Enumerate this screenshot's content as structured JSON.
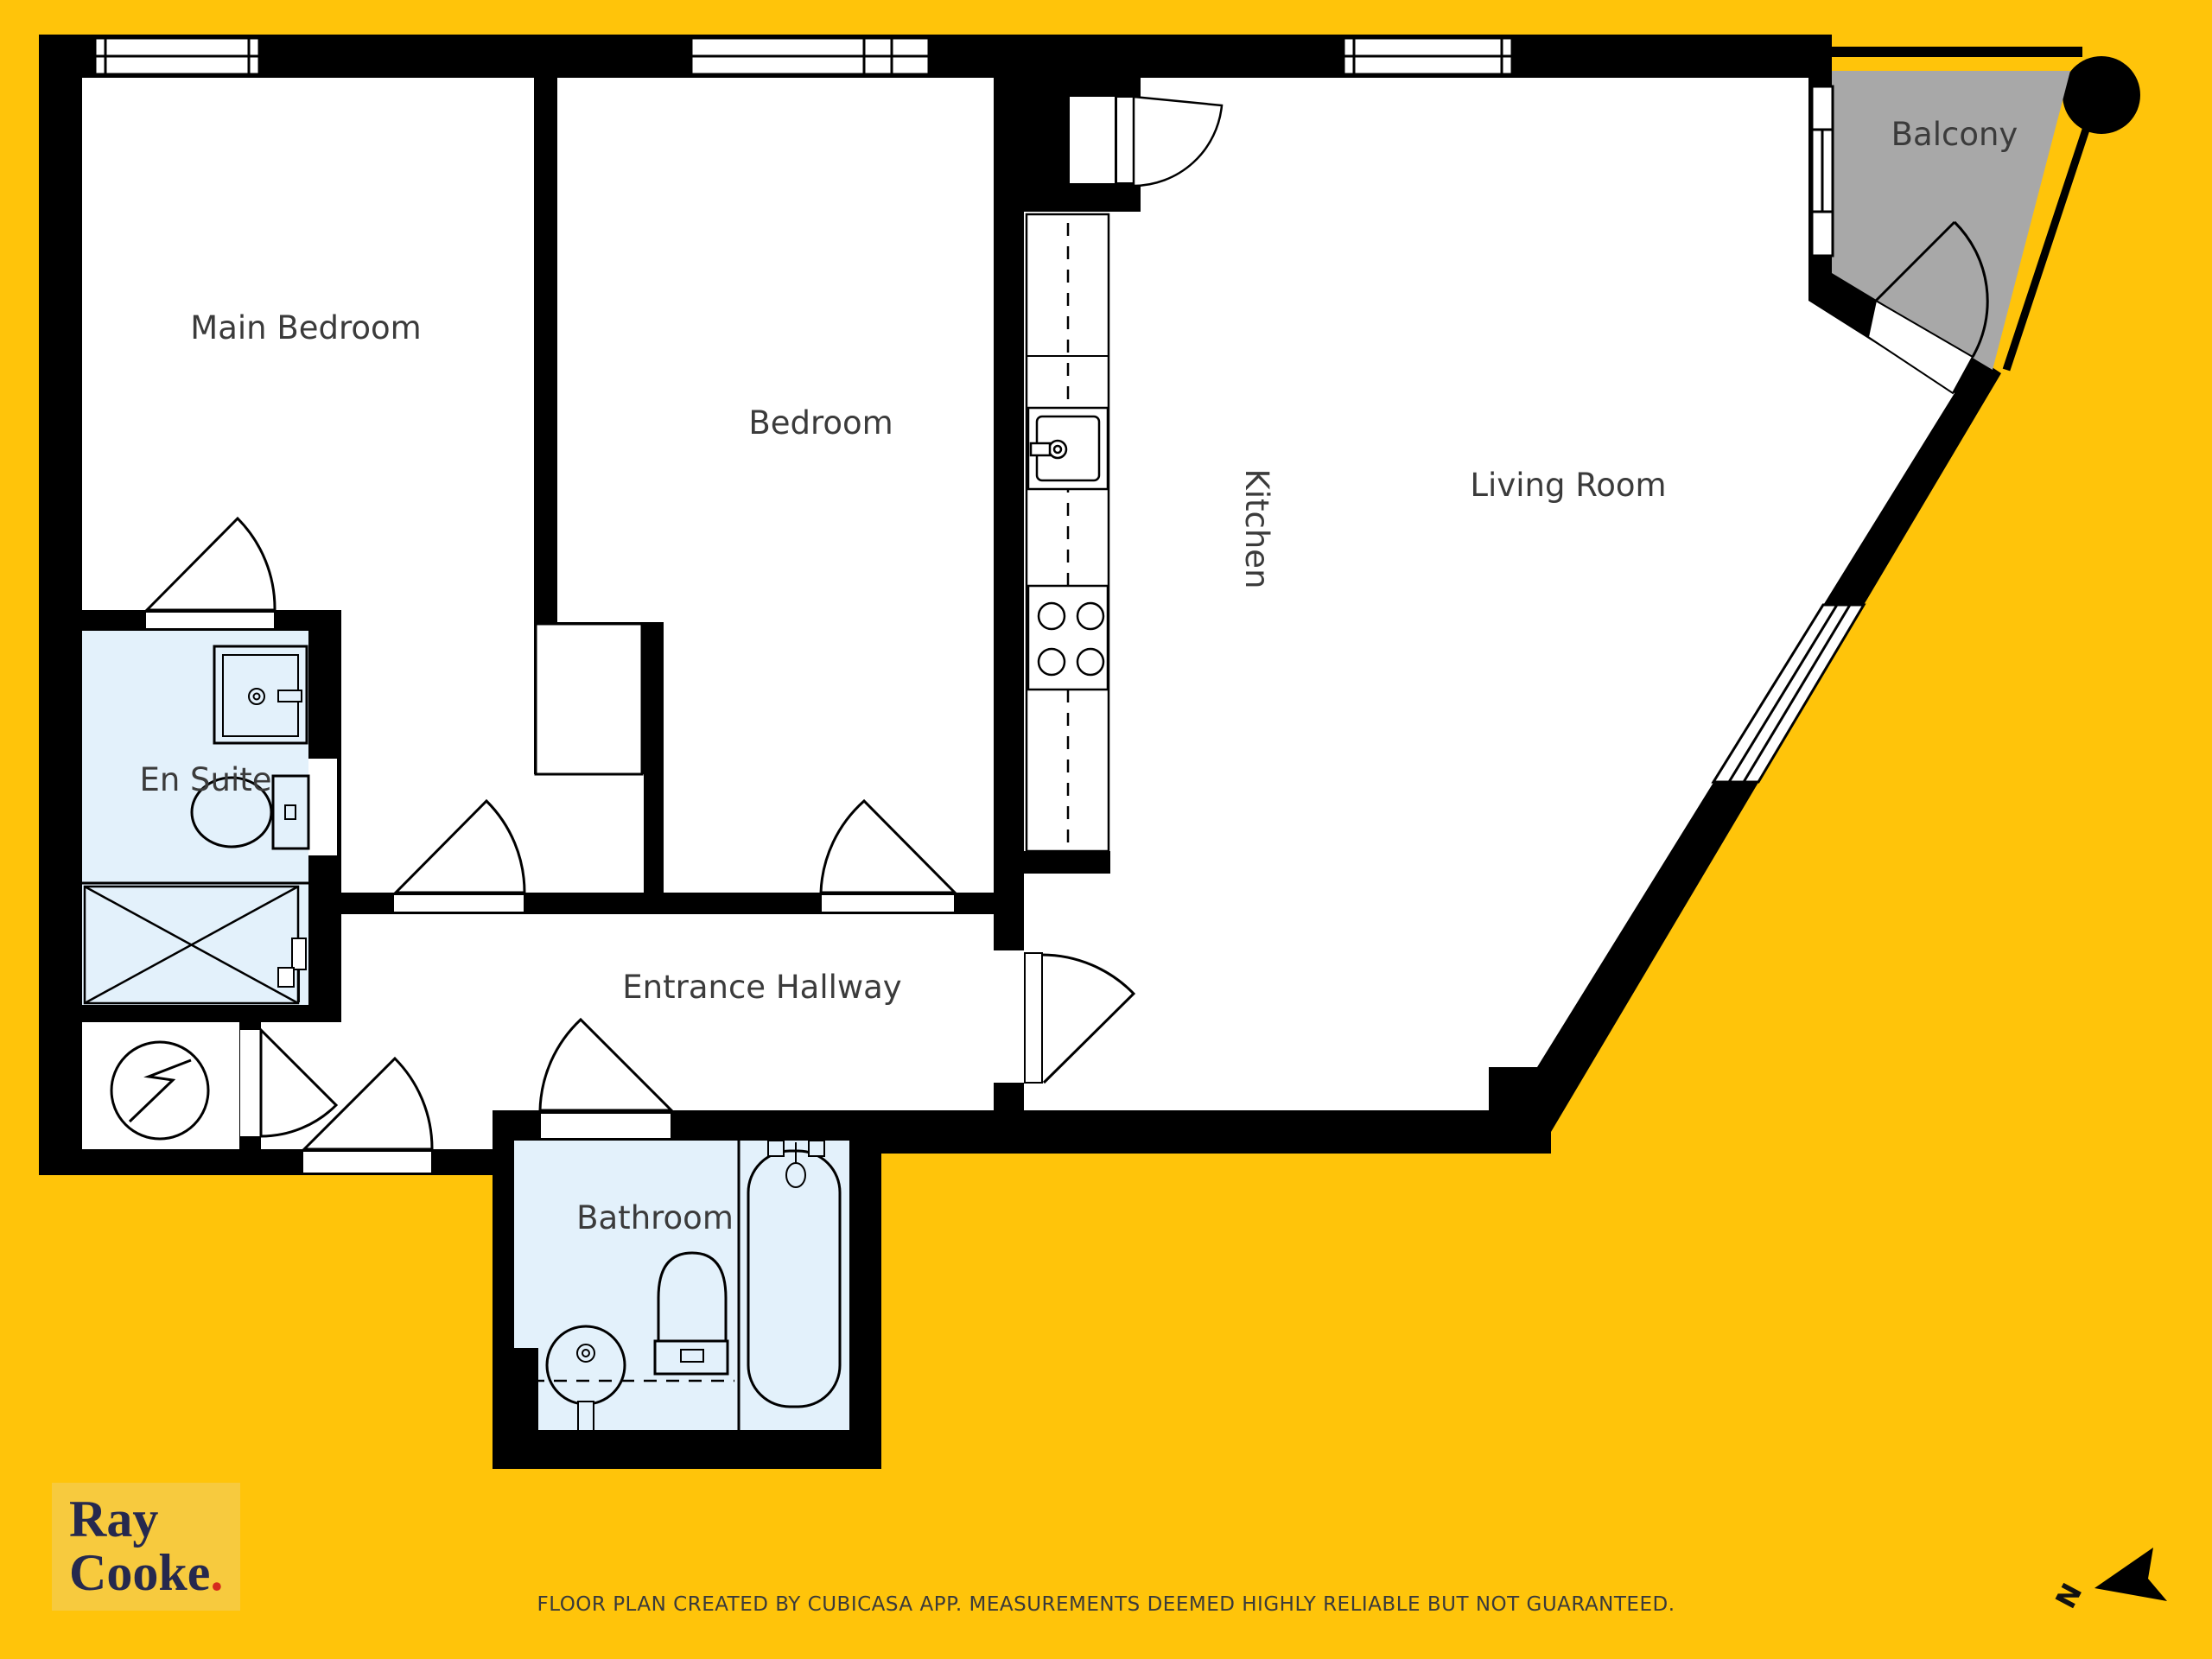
{
  "colors": {
    "background": "#FFC40A",
    "wall": "#000000",
    "wet_room_fill": "#E3F1FB",
    "balcony_fill": "#A8A8A8",
    "room_label": "#3B3B3B",
    "logo_navy": "#26294E",
    "logo_red": "#D52B1E",
    "logo_patch": "#F7CA3E"
  },
  "rooms": [
    {
      "id": "main-bedroom",
      "label": "Main Bedroom"
    },
    {
      "id": "bedroom",
      "label": "Bedroom"
    },
    {
      "id": "kitchen",
      "label": "Kitchen"
    },
    {
      "id": "living-room",
      "label": "Living Room"
    },
    {
      "id": "balcony",
      "label": "Balcony"
    },
    {
      "id": "en-suite",
      "label": "En Suite"
    },
    {
      "id": "entrance-hallway",
      "label": "Entrance Hallway"
    },
    {
      "id": "bathroom",
      "label": "Bathroom"
    }
  ],
  "branding": {
    "line1": "Ray",
    "line2": "Cooke",
    "period": "."
  },
  "footer": {
    "disclaimer": "FLOOR PLAN CREATED BY CUBICASA APP. MEASUREMENTS DEEMED HIGHLY RELIABLE BUT NOT GUARANTEED."
  },
  "compass": {
    "label": "N"
  }
}
